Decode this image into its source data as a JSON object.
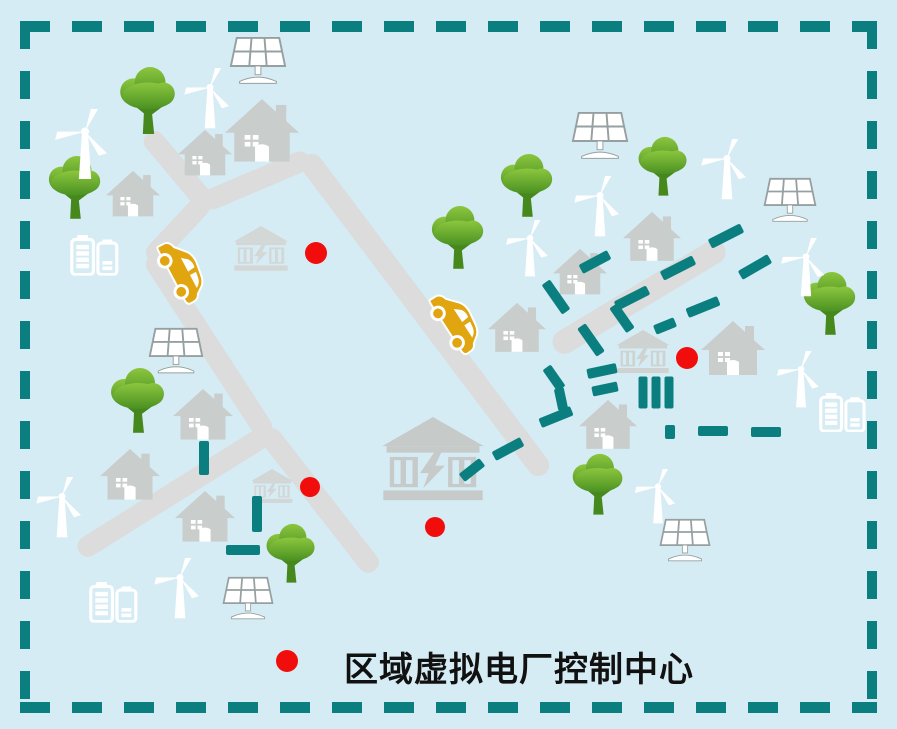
{
  "legend": {
    "label": "区域虚拟电厂控制中心"
  },
  "colors": {
    "background": "#d5ecf4",
    "teal": "#0b7f80",
    "road": "#dbdcdb",
    "building": "#c9cdcc",
    "tree_light": "#8cc63e",
    "tree_dark": "#4a9122",
    "trunk": "#47881c",
    "car": "#e0a50f",
    "red": "#f20d0d",
    "white": "#ffffff",
    "panel_line": "#97a0a0",
    "text": "#111111"
  },
  "scene": {
    "roads": [
      {
        "x": 177,
        "y": 168,
        "l": 92,
        "r": 50
      },
      {
        "x": 256,
        "y": 180,
        "l": 116,
        "r": -23
      },
      {
        "x": 425,
        "y": 315,
        "l": 398,
        "r": 53,
        "w": 22
      },
      {
        "x": 178,
        "y": 229,
        "l": 84,
        "r": 133
      },
      {
        "x": 209,
        "y": 345,
        "l": 214,
        "r": 57
      },
      {
        "x": 174,
        "y": 492,
        "l": 224,
        "r": 148
      },
      {
        "x": 320,
        "y": 500,
        "l": 178,
        "r": 52
      },
      {
        "x": 639,
        "y": 297,
        "l": 198,
        "r": -31,
        "w": 24
      }
    ],
    "houses": [
      {
        "x": 262,
        "y": 130,
        "w": 74
      },
      {
        "x": 205,
        "y": 153,
        "w": 54
      },
      {
        "x": 133,
        "y": 194,
        "w": 54
      },
      {
        "x": 652,
        "y": 236,
        "w": 58
      },
      {
        "x": 580,
        "y": 272,
        "w": 54
      },
      {
        "x": 517,
        "y": 327,
        "w": 58
      },
      {
        "x": 733,
        "y": 348,
        "w": 64
      },
      {
        "x": 608,
        "y": 424,
        "w": 58
      },
      {
        "x": 203,
        "y": 414,
        "w": 60
      },
      {
        "x": 130,
        "y": 474,
        "w": 60
      },
      {
        "x": 205,
        "y": 516,
        "w": 60
      }
    ],
    "trees": [
      {
        "x": 148,
        "y": 100,
        "s": 66
      },
      {
        "x": 75,
        "y": 187,
        "s": 62
      },
      {
        "x": 458,
        "y": 237,
        "s": 62
      },
      {
        "x": 527,
        "y": 185,
        "s": 62
      },
      {
        "x": 663,
        "y": 166,
        "s": 58
      },
      {
        "x": 830,
        "y": 303,
        "s": 62
      },
      {
        "x": 138,
        "y": 400,
        "s": 64
      },
      {
        "x": 291,
        "y": 553,
        "s": 58
      },
      {
        "x": 598,
        "y": 484,
        "s": 60
      }
    ],
    "turbines": [
      {
        "x": 85,
        "y": 145,
        "s": 72
      },
      {
        "x": 210,
        "y": 99,
        "s": 62
      },
      {
        "x": 600,
        "y": 207,
        "s": 62
      },
      {
        "x": 530,
        "y": 249,
        "s": 58
      },
      {
        "x": 727,
        "y": 170,
        "s": 62
      },
      {
        "x": 806,
        "y": 268,
        "s": 60
      },
      {
        "x": 801,
        "y": 380,
        "s": 58
      },
      {
        "x": 62,
        "y": 508,
        "s": 62
      },
      {
        "x": 180,
        "y": 589,
        "s": 62
      },
      {
        "x": 658,
        "y": 497,
        "s": 56
      }
    ],
    "solar_panels": [
      {
        "x": 258,
        "y": 60,
        "w": 62
      },
      {
        "x": 600,
        "y": 135,
        "w": 62
      },
      {
        "x": 790,
        "y": 200,
        "w": 58
      },
      {
        "x": 176,
        "y": 350,
        "w": 60
      },
      {
        "x": 248,
        "y": 598,
        "w": 56
      },
      {
        "x": 685,
        "y": 540,
        "w": 56
      }
    ],
    "batteries": [
      {
        "x": 97,
        "y": 255,
        "w": 54
      },
      {
        "x": 845,
        "y": 412,
        "w": 52
      },
      {
        "x": 116,
        "y": 602,
        "w": 54
      }
    ],
    "cars": [
      {
        "x": 182,
        "y": 270,
        "rot": 62,
        "w": 74
      },
      {
        "x": 456,
        "y": 321,
        "rot": 57,
        "w": 74
      }
    ],
    "power_plants": [
      {
        "x": 261,
        "y": 249,
        "w": 58,
        "shade": "#d3d7d6"
      },
      {
        "x": 433,
        "y": 459,
        "w": 108,
        "shade": "#c6cac9"
      },
      {
        "x": 643,
        "y": 352,
        "w": 56,
        "shade": "#ced2d1"
      },
      {
        "x": 272,
        "y": 486,
        "w": 44,
        "shade": "#d2d6d5"
      }
    ],
    "power_line_dashes": [
      {
        "x": 204,
        "y": 458,
        "r": 90,
        "l": 34
      },
      {
        "x": 257,
        "y": 514,
        "r": 90,
        "l": 36
      },
      {
        "x": 243,
        "y": 550,
        "r": 0,
        "l": 34
      },
      {
        "x": 472,
        "y": 470,
        "r": -38,
        "l": 26
      },
      {
        "x": 508,
        "y": 449,
        "r": -28,
        "l": 32
      },
      {
        "x": 556,
        "y": 417,
        "r": -22,
        "l": 34
      },
      {
        "x": 602,
        "y": 371,
        "r": -12,
        "l": 30
      },
      {
        "x": 605,
        "y": 389,
        "r": -12,
        "l": 26
      },
      {
        "x": 556,
        "y": 297,
        "r": 55,
        "l": 36
      },
      {
        "x": 591,
        "y": 340,
        "r": 55,
        "l": 34
      },
      {
        "x": 622,
        "y": 318,
        "r": 55,
        "l": 30
      },
      {
        "x": 554,
        "y": 378,
        "r": 55,
        "l": 26
      },
      {
        "x": 561,
        "y": 399,
        "r": 78,
        "l": 22
      },
      {
        "x": 595,
        "y": 262,
        "r": -28,
        "l": 32
      },
      {
        "x": 632,
        "y": 298,
        "r": -27,
        "l": 36
      },
      {
        "x": 678,
        "y": 268,
        "r": -27,
        "l": 36
      },
      {
        "x": 726,
        "y": 236,
        "r": -27,
        "l": 36
      },
      {
        "x": 665,
        "y": 326,
        "r": -22,
        "l": 22
      },
      {
        "x": 703,
        "y": 307,
        "r": -22,
        "l": 34
      },
      {
        "x": 755,
        "y": 267,
        "r": -30,
        "l": 34
      },
      {
        "x": 670,
        "y": 432,
        "r": 90,
        "l": 14
      },
      {
        "x": 713,
        "y": 431,
        "r": 0,
        "l": 30
      },
      {
        "x": 766,
        "y": 432,
        "r": 0,
        "l": 30
      },
      {
        "x": 643,
        "y": 392,
        "r": 90,
        "l": 32,
        "w": 9
      },
      {
        "x": 656,
        "y": 392,
        "r": 90,
        "l": 32,
        "w": 9
      },
      {
        "x": 669,
        "y": 392,
        "r": 90,
        "l": 32,
        "w": 9
      }
    ],
    "control_center_dots": [
      {
        "x": 316,
        "y": 253,
        "r": 11
      },
      {
        "x": 687,
        "y": 358,
        "r": 11
      },
      {
        "x": 310,
        "y": 487,
        "r": 10
      },
      {
        "x": 435,
        "y": 527,
        "r": 10
      }
    ]
  }
}
